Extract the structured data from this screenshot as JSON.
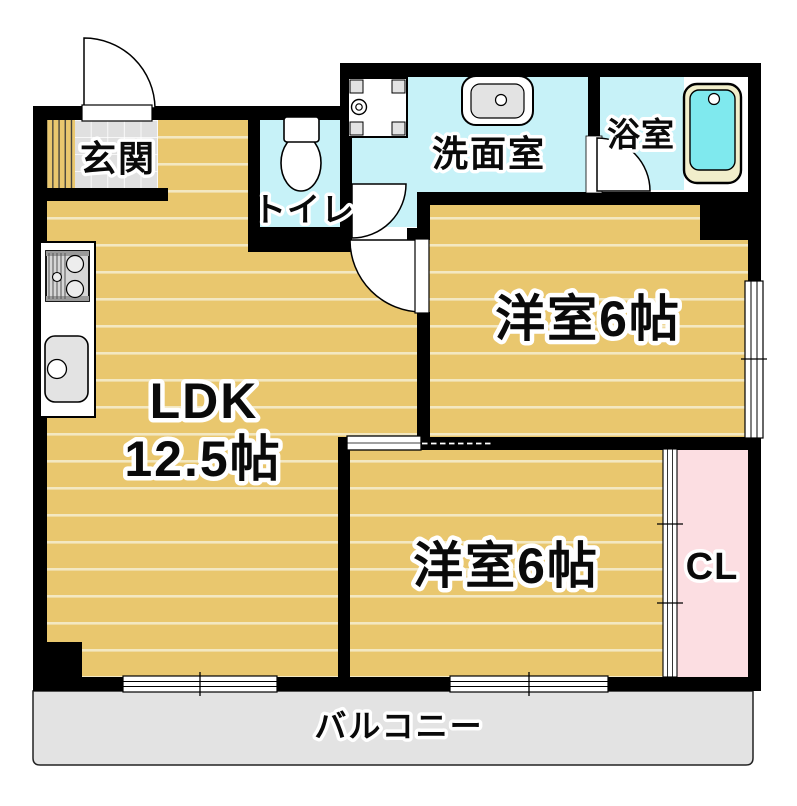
{
  "floorplan": {
    "rooms": {
      "entrance": {
        "label": "玄関"
      },
      "toilet": {
        "label": "トイレ"
      },
      "washroom": {
        "label": "洗面室"
      },
      "bathroom": {
        "label": "浴室"
      },
      "western_room_upper": {
        "label": "洋室6帖"
      },
      "western_room_lower": {
        "label": "洋室6帖"
      },
      "ldk": {
        "label": "LDK",
        "size": "12.5帖"
      },
      "closet": {
        "label": "CL"
      },
      "balcony": {
        "label": "バルコニー"
      }
    },
    "fixtures": [
      "entrance-door",
      "shoe-cabinet",
      "toilet-bowl",
      "washing-machine-pan",
      "washbasin",
      "bathtub",
      "bath-door",
      "gas-stove",
      "kitchen-sink",
      "hinged-door",
      "sliding-door",
      "closet-sliding-door",
      "sliding-window"
    ],
    "colors": {
      "wall": "#000000",
      "flooring": "#e9c76e",
      "flooring_line": "#f3e8c2",
      "wet_area": "#c7f2f8",
      "closet_pink": "#fcdee2",
      "balcony_gray": "#e3e3e3",
      "tile_gray": "#e0e0e0",
      "tub_rim": "#f1eecb",
      "tub_water": "#7fe9ee",
      "fixture_gray": "#e3e3e3",
      "wood_line": "#3a3a3a"
    }
  }
}
